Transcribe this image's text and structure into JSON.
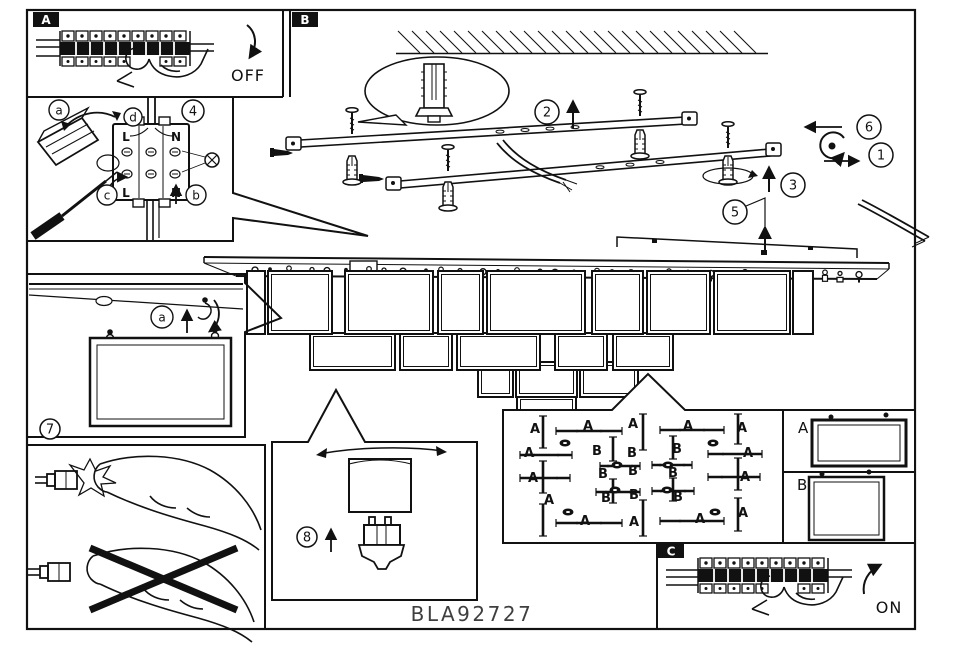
{
  "product_code": "BLA92727",
  "panel_a": {
    "label": "A",
    "state_text": "OFF"
  },
  "panel_b": {
    "label": "B",
    "step_1": "1",
    "step_2": "2",
    "step_3": "3",
    "step_5": "5",
    "step_6": "6"
  },
  "panel_wiring": {
    "step_4": "4",
    "ref_a": "a",
    "ref_b": "b",
    "ref_c": "c",
    "ref_d": "d",
    "terminal_top_left": "L",
    "terminal_top_right": "N",
    "terminal_bottom_left": "L",
    "terminal_bottom_right": "N"
  },
  "panel_hanging": {
    "step_7": "7",
    "ref_a": "a"
  },
  "panel_bulb": {
    "step_8": "8"
  },
  "panel_layout_plan": {
    "labels": [
      {
        "t": "A",
        "x": 535,
        "y": 433
      },
      {
        "t": "A",
        "x": 588,
        "y": 430
      },
      {
        "t": "A",
        "x": 633,
        "y": 428
      },
      {
        "t": "A",
        "x": 688,
        "y": 430
      },
      {
        "t": "A",
        "x": 742,
        "y": 432
      },
      {
        "t": "A",
        "x": 529,
        "y": 457
      },
      {
        "t": "A",
        "x": 748,
        "y": 457
      },
      {
        "t": "A",
        "x": 533,
        "y": 482
      },
      {
        "t": "A",
        "x": 745,
        "y": 481
      },
      {
        "t": "A",
        "x": 549,
        "y": 504
      },
      {
        "t": "A",
        "x": 585,
        "y": 525
      },
      {
        "t": "A",
        "x": 634,
        "y": 526
      },
      {
        "t": "A",
        "x": 700,
        "y": 523
      },
      {
        "t": "A",
        "x": 743,
        "y": 517
      },
      {
        "t": "B",
        "x": 597,
        "y": 455
      },
      {
        "t": "B",
        "x": 632,
        "y": 457
      },
      {
        "t": "B",
        "x": 677,
        "y": 453
      },
      {
        "t": "B",
        "x": 603,
        "y": 478
      },
      {
        "t": "B",
        "x": 633,
        "y": 475
      },
      {
        "t": "B",
        "x": 673,
        "y": 477
      },
      {
        "t": "B",
        "x": 606,
        "y": 502
      },
      {
        "t": "B",
        "x": 634,
        "y": 499
      },
      {
        "t": "B",
        "x": 678,
        "y": 501
      }
    ]
  },
  "panel_samples": {
    "label_a": "A",
    "label_b": "B"
  },
  "panel_c": {
    "label": "C",
    "state_text": "ON"
  }
}
